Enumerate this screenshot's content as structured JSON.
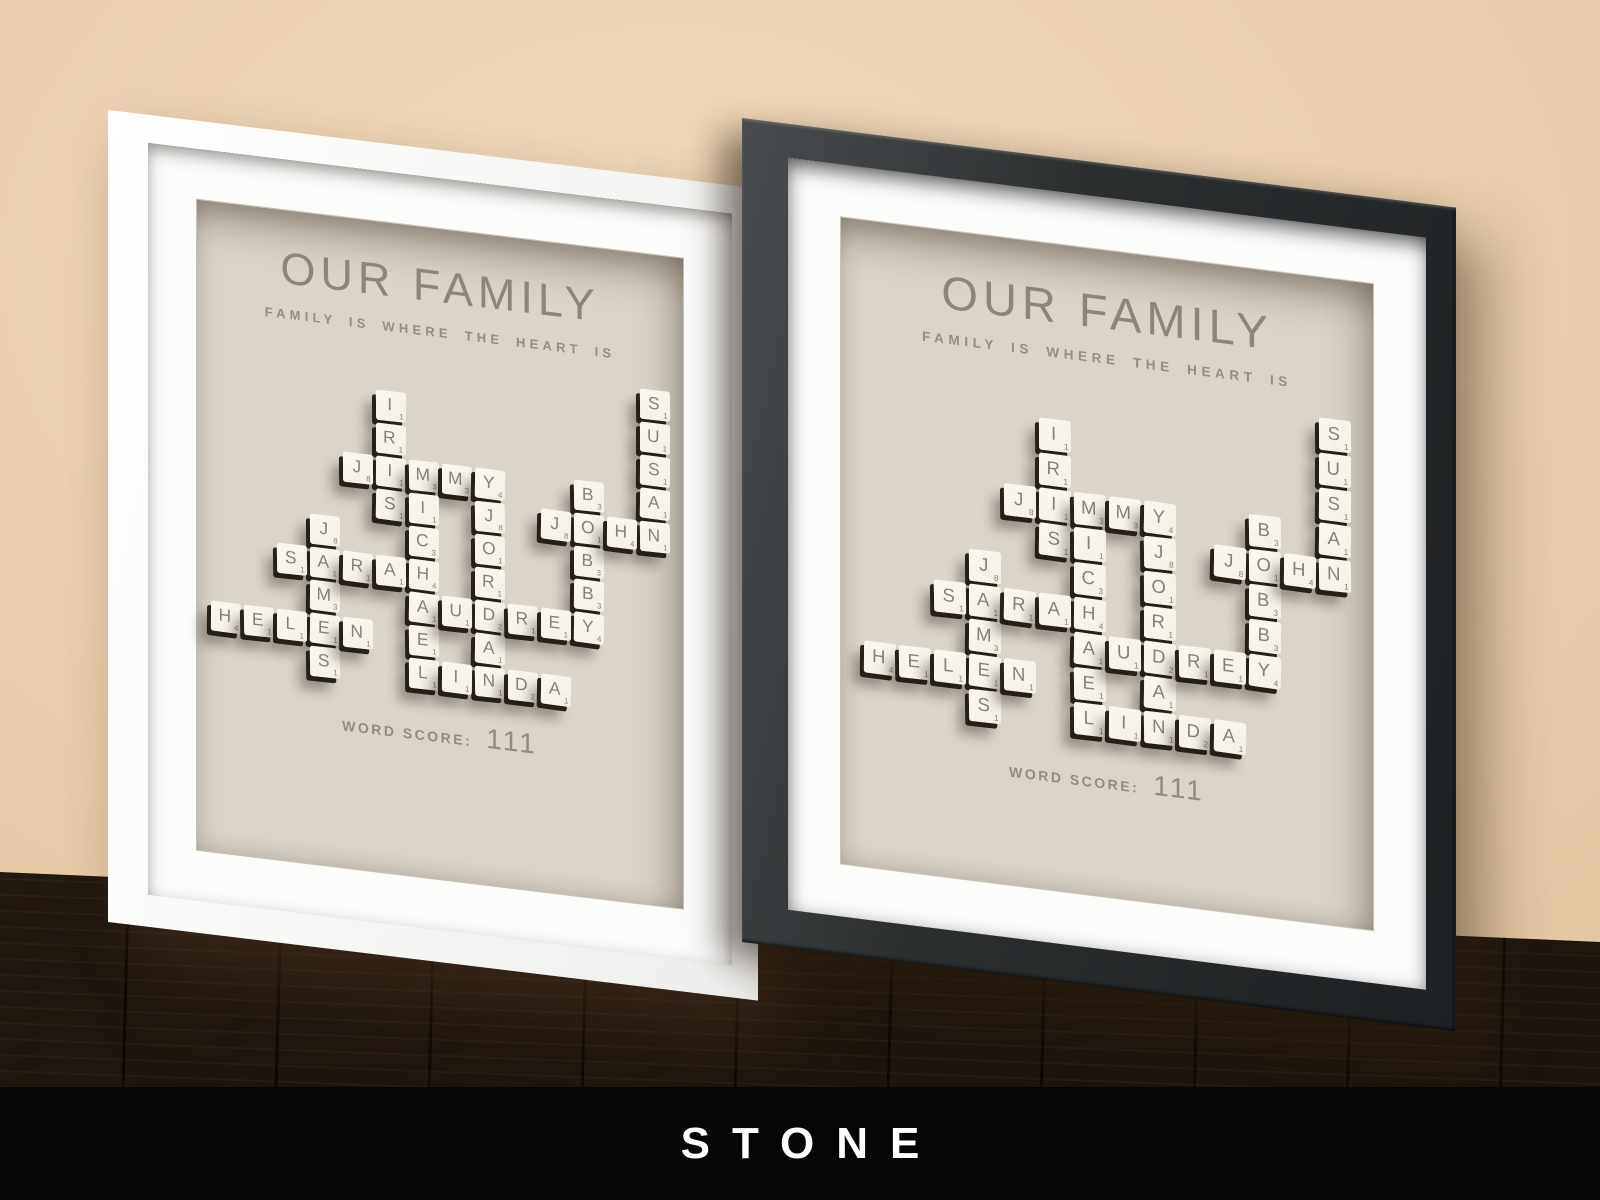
{
  "branding": {
    "label": "STONE"
  },
  "artwork": {
    "title": "OUR FAMILY",
    "subtitle": "FAMILY IS WHERE THE HEART IS",
    "word_score_label": "WORD SCORE:",
    "word_score_value": "111",
    "grid": {
      "cols": 14,
      "rows": 10
    },
    "words": [
      {
        "word": "SUSAN",
        "dir": "v",
        "col": 13,
        "row": 0
      },
      {
        "word": "IRIS",
        "dir": "v",
        "col": 5,
        "row": 1
      },
      {
        "word": "JIMMY",
        "dir": "h",
        "col": 4,
        "row": 3
      },
      {
        "word": "MICHAEL",
        "dir": "v",
        "col": 6,
        "row": 3
      },
      {
        "word": "BOBBY",
        "dir": "v",
        "col": 11,
        "row": 3
      },
      {
        "word": "JOHN",
        "dir": "h",
        "col": 10,
        "row": 4
      },
      {
        "word": "JORDAN",
        "dir": "v",
        "col": 8,
        "row": 4
      },
      {
        "word": "JAMES",
        "dir": "v",
        "col": 3,
        "row": 5
      },
      {
        "word": "SARAH",
        "dir": "h",
        "col": 2,
        "row": 6
      },
      {
        "word": "AUDREY",
        "dir": "h",
        "col": 6,
        "row": 7
      },
      {
        "word": "HELEN",
        "dir": "h",
        "col": 0,
        "row": 8
      },
      {
        "word": "LINDA",
        "dir": "h",
        "col": 6,
        "row": 9
      }
    ],
    "letter_values": {
      "A": 1,
      "B": 3,
      "C": 3,
      "D": 2,
      "E": 1,
      "H": 4,
      "I": 1,
      "J": 8,
      "L": 1,
      "M": 3,
      "N": 1,
      "O": 1,
      "R": 1,
      "S": 1,
      "U": 1,
      "Y": 4
    }
  },
  "frames": [
    {
      "id": "white",
      "frame_color": "#f7f7f5"
    },
    {
      "id": "black",
      "frame_color": "#2a2d2e"
    }
  ],
  "colors": {
    "wall": "#ead0b0",
    "floor": "#2a1f14",
    "brand_bar_bg": "#060606",
    "brand_bar_text": "#ffffff",
    "mat": "#fcfcfb",
    "art_background": "#dad4c9",
    "art_text": "#8f8476",
    "tile_face": "#f7f4ec",
    "tile_text": "#8b8072",
    "tile_shadow": "#211a13"
  }
}
